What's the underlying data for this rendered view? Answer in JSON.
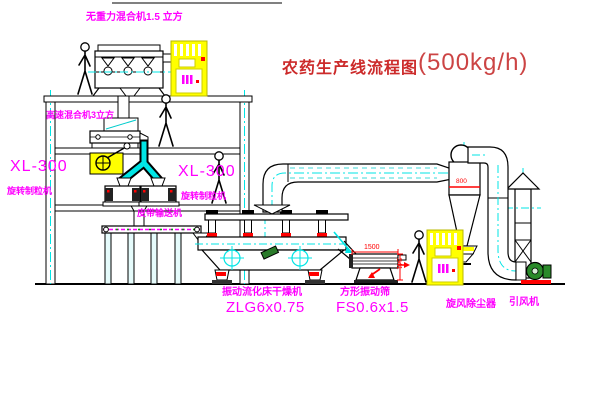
{
  "title": {
    "prefix": "农药生产线流程图",
    "capacity": "(500kg/h)"
  },
  "equipment": {
    "gravity_mixer": "无重力混合机1.5 立方",
    "high_speed_mixer": "高速混合机3立方",
    "granulator_left_model": "XL-300",
    "granulator_left_name": "旋转制粒机",
    "granulator_right_model": "XL-300",
    "granulator_right_name": "旋转制粒机",
    "belt_conveyor": "皮带输送机",
    "dryer_name": "振动流化床干燥机",
    "dryer_model": "ZLG6x0.75",
    "screen_name": "方形振动筛",
    "screen_model": "FS0.6x1.5",
    "cyclone_name": "旋风除尘器",
    "fan_name": "引风机"
  },
  "dimensions": {
    "screen_length": "1500",
    "screen_height": "541",
    "cyclone_diameter": "800"
  },
  "colors": {
    "label": "#ff00ff",
    "title": "#cc2a2a",
    "dimension": "#ff0000",
    "highlight": "#ffff00",
    "centerline": "#00e5e5",
    "fan": "#2a8a2a"
  }
}
